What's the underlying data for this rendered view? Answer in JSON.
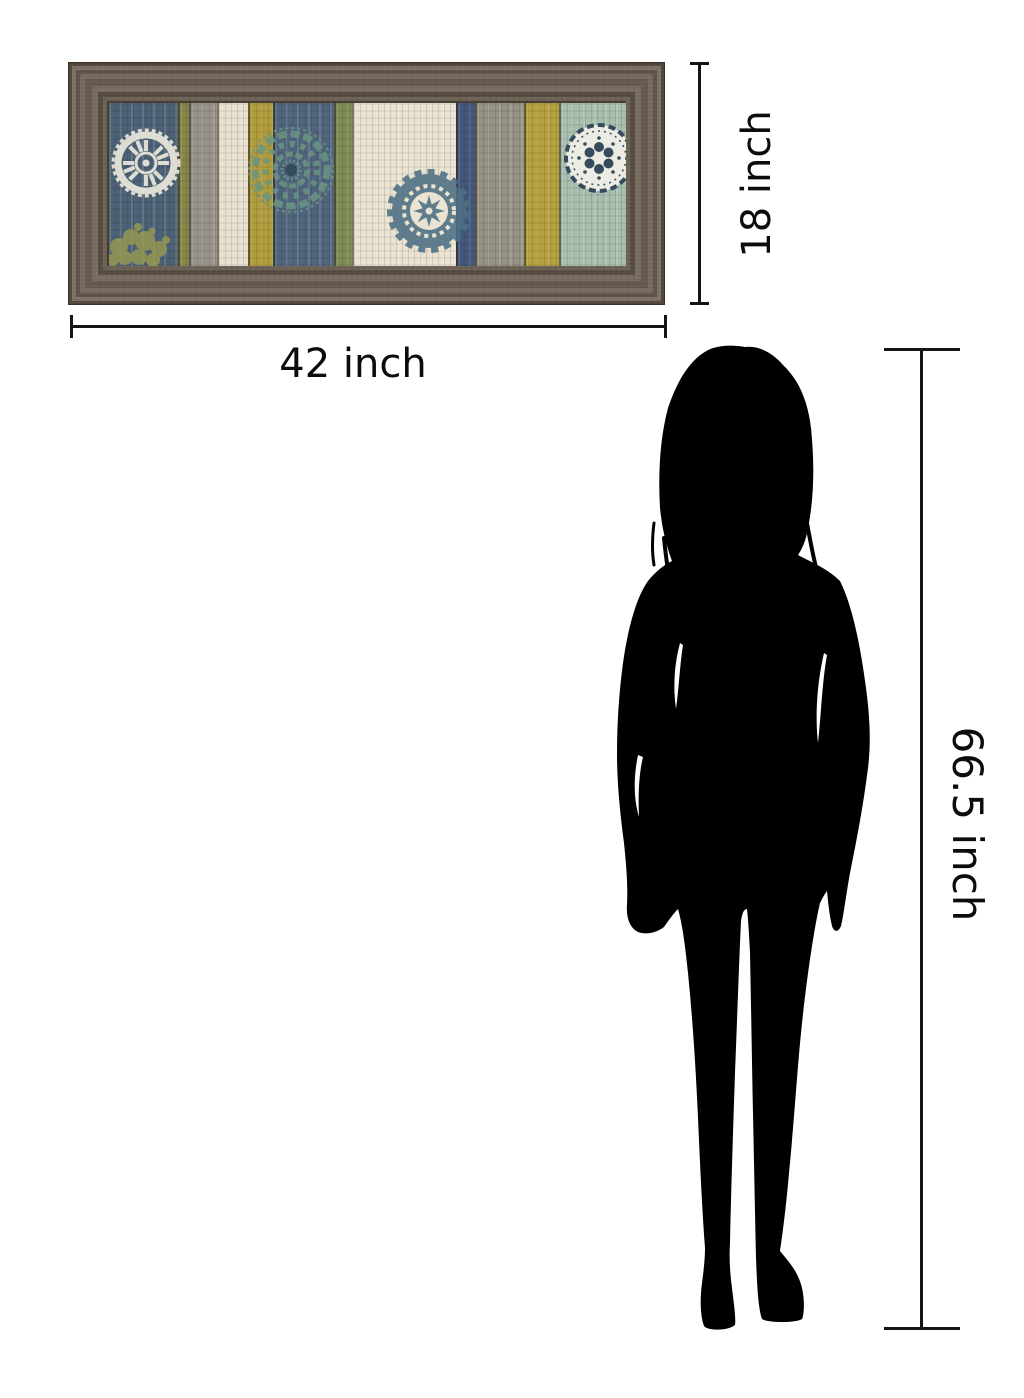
{
  "scene": {
    "description": "Product size comparison graphic: framed striped wall art with medallions, dimension arrows, and a standing woman silhouette for scale",
    "background_color": "#ffffff",
    "annotation_color": "#151515"
  },
  "artwork": {
    "frame_color": "#6f6457",
    "planks": [
      {
        "color": "#4d6277",
        "width": 69
      },
      {
        "color": "#87874b",
        "width": 11
      },
      {
        "color": "#99948a",
        "width": 28
      },
      {
        "color": "#e8e1d0",
        "width": 31
      },
      {
        "color": "#b29d3e",
        "width": 25
      },
      {
        "color": "#51667e",
        "width": 61
      },
      {
        "color": "#7c8d54",
        "width": 18
      },
      {
        "color": "#eae3d2",
        "width": 104
      },
      {
        "color": "#42577c",
        "width": 19
      },
      {
        "color": "#979384",
        "width": 49
      },
      {
        "color": "#b5a13f",
        "width": 35
      },
      {
        "color": "#a7c0af",
        "width": 67
      }
    ],
    "medallions": [
      "suzani-white-medallion",
      "damask-olive-motif",
      "lace-teal-medallion",
      "suzani-navy-medallion",
      "doily-white-medallion"
    ]
  },
  "dimensions": {
    "art_width_label": "42 inch",
    "art_height_label": "18 inch",
    "figure_height_label": "66.5 inch"
  },
  "figure": {
    "type": "woman-silhouette",
    "color": "#000000"
  }
}
